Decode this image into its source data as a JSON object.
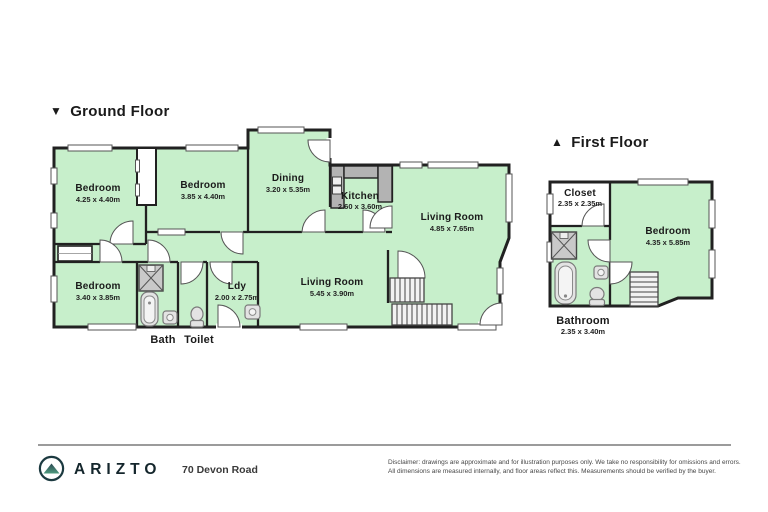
{
  "ground_floor": {
    "title": "Ground Floor",
    "rooms": {
      "bedroom1": {
        "name": "Bedroom",
        "dims": "4.25 x 4.40m"
      },
      "bedroom2": {
        "name": "Bedroom",
        "dims": "3.85 x 4.40m"
      },
      "dining": {
        "name": "Dining",
        "dims": "3.20 x 5.35m"
      },
      "kitchen": {
        "name": "Kitchen",
        "dims": "2.60 x 3.60m"
      },
      "living1": {
        "name": "Living Room",
        "dims": "4.85 x 7.65m"
      },
      "bedroom3": {
        "name": "Bedroom",
        "dims": "3.40 x 3.85m"
      },
      "ldy": {
        "name": "Ldy",
        "dims": "2.00 x 2.75m"
      },
      "living2": {
        "name": "Living Room",
        "dims": "5.45 x 3.90m"
      },
      "bath": {
        "name": "Bath"
      },
      "toilet": {
        "name": "Toilet"
      }
    }
  },
  "first_floor": {
    "title": "First Floor",
    "rooms": {
      "closet": {
        "name": "Closet",
        "dims": "2.35 x 2.35m"
      },
      "bedroom": {
        "name": "Bedroom",
        "dims": "4.35 x 5.85m"
      },
      "bathroom": {
        "name": "Bathroom",
        "dims": "2.35 x 3.40m"
      }
    }
  },
  "icons": {
    "ground_marker": "▼",
    "first_marker": "▲",
    "logo": "mountain-in-circle"
  },
  "footer": {
    "brand": "ARIZTO",
    "address": "70 Devon Road",
    "disclaimer_line1": "Disclaimer: drawings are approximate and for illustration purposes only. We take no responsibility for omissions and errors.",
    "disclaimer_line2": "All dimensions are measured internally, and floor areas reflect this. Measurements should be verified by the buyer."
  },
  "colors": {
    "room_fill": "#c7efcb",
    "wall": "#212121",
    "counter": "#b3b3b3",
    "stairs_fill": "#f2f2f2",
    "accent_teal": "#4e9a7e",
    "brand_text": "#14262c"
  }
}
